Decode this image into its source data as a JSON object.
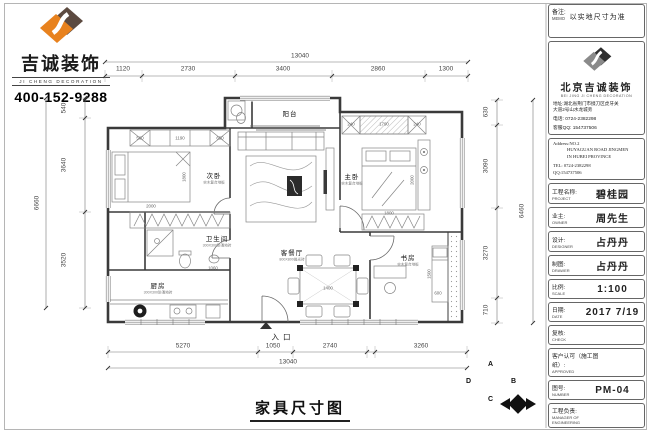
{
  "header": {
    "logo_cn": "吉诚装饰",
    "logo_en": "JI CHENG DECORATION",
    "phone": "400-152-9288"
  },
  "titleblock": {
    "memo_label": "备注:",
    "memo_label_en": "MEMO",
    "memo_text": "以实地尺寸为准",
    "company": {
      "name": "北京吉诚装饰",
      "name_en": "BEI JING JI CHENG DECORATION",
      "address1": "地址:湖北省荆门市掇刀区虎牙关",
      "address2": "大道2号山水龙城旁",
      "tel": "电话: 0724-2382298",
      "qq": "客服QQ: 154737506"
    },
    "address_en": {
      "line1": "Address:NO.2",
      "line2": "HUYAGUAN ROAD JINGMEN",
      "line3": "IN HUBEI PROVINCE",
      "tel": "TEL: 0724-2382298",
      "qq": "QQ:154737506"
    },
    "fields": [
      {
        "label": "工程名称:",
        "label_en": "PROJECT",
        "value": "碧桂园"
      },
      {
        "label": "业主:",
        "label_en": "OWNER",
        "value": "周先生"
      },
      {
        "label": "设计:",
        "label_en": "DESIGNER",
        "value": "占丹丹"
      },
      {
        "label": "制图:",
        "label_en": "DRAWER",
        "value": "占丹丹"
      },
      {
        "label": "比例:",
        "label_en": "SCALE",
        "value": "1:100"
      },
      {
        "label": "日期:",
        "label_en": "DATE",
        "value": "2017 7/19"
      },
      {
        "label": "复核:",
        "label_en": "CHECK",
        "value": ""
      },
      {
        "label": "客户认可（施工图纸）:",
        "label_en": "APPROVED",
        "value": ""
      },
      {
        "label": "图号:",
        "label_en": "NUMBER",
        "value": "PM-04"
      },
      {
        "label": "工程负责:",
        "label_en": "MANAGER OF ENGINEERING",
        "value": ""
      }
    ]
  },
  "plan": {
    "drawing_title": "家具尺寸图",
    "dims": {
      "top_overall": "13040",
      "top_segments": [
        "1120",
        "2730",
        "3400",
        "2860",
        "1300"
      ],
      "bottom_segments": [
        "5270",
        "1050",
        "2740",
        "3260"
      ],
      "bottom_overall": "13040",
      "left_outer": "6660",
      "left_segments": [
        "540",
        "3640",
        "3520"
      ],
      "right_segments": [
        "630",
        "3090",
        "3270",
        "710"
      ],
      "right_outer": "6460"
    },
    "labels": [
      {
        "text": "13040",
        "x": 300,
        "y": 56,
        "cls": "dim"
      },
      {
        "text": "1120",
        "x": 123,
        "y": 69,
        "cls": "dim"
      },
      {
        "text": "2730",
        "x": 188,
        "y": 69,
        "cls": "dim"
      },
      {
        "text": "3400",
        "x": 283,
        "y": 69,
        "cls": "dim"
      },
      {
        "text": "2860",
        "x": 378,
        "y": 69,
        "cls": "dim"
      },
      {
        "text": "1300",
        "x": 446,
        "y": 69,
        "cls": "dim"
      },
      {
        "text": "5270",
        "x": 183,
        "y": 346,
        "cls": "dim"
      },
      {
        "text": "1050",
        "x": 273,
        "y": 346,
        "cls": "dim"
      },
      {
        "text": "2740",
        "x": 330,
        "y": 346,
        "cls": "dim"
      },
      {
        "text": "3260",
        "x": 421,
        "y": 346,
        "cls": "dim"
      },
      {
        "text": "13040",
        "x": 288,
        "y": 362,
        "cls": "dim"
      },
      {
        "text": "540",
        "x": 64,
        "y": 108,
        "rot": -90,
        "cls": "dim"
      },
      {
        "text": "3640",
        "x": 64,
        "y": 165,
        "rot": -90,
        "cls": "dim"
      },
      {
        "text": "3520",
        "x": 64,
        "y": 260,
        "rot": -90,
        "cls": "dim"
      },
      {
        "text": "6660",
        "x": 37,
        "y": 203,
        "rot": -90,
        "cls": "dim"
      },
      {
        "text": "630",
        "x": 486,
        "y": 112,
        "rot": -90,
        "cls": "dim"
      },
      {
        "text": "3090",
        "x": 486,
        "y": 166,
        "rot": -90,
        "cls": "dim"
      },
      {
        "text": "3270",
        "x": 486,
        "y": 253,
        "rot": -90,
        "cls": "dim"
      },
      {
        "text": "710",
        "x": 486,
        "y": 310,
        "rot": -90,
        "cls": "dim"
      },
      {
        "text": "6460",
        "x": 522,
        "y": 211,
        "rot": -90,
        "cls": "dim"
      },
      {
        "text": "阳台",
        "x": 290,
        "y": 113,
        "cls": "room"
      },
      {
        "text": "次卧",
        "x": 214,
        "y": 175,
        "cls": "room"
      },
      {
        "text": "实木复合地板",
        "x": 214,
        "y": 183,
        "cls": "roomsub"
      },
      {
        "text": "主卧",
        "x": 352,
        "y": 176,
        "cls": "room"
      },
      {
        "text": "实木复合地板",
        "x": 352,
        "y": 184,
        "cls": "roomsub"
      },
      {
        "text": "卫生间",
        "x": 217,
        "y": 238,
        "cls": "room"
      },
      {
        "text": "300X300防滑地砖",
        "x": 217,
        "y": 246,
        "cls": "roomsub"
      },
      {
        "text": "厨房",
        "x": 158,
        "y": 285,
        "cls": "room"
      },
      {
        "text": "300X300防滑地砖",
        "x": 158,
        "y": 293,
        "cls": "roomsub"
      },
      {
        "text": "客餐厅",
        "x": 292,
        "y": 252,
        "cls": "room"
      },
      {
        "text": "800X800抛光砖",
        "x": 292,
        "y": 260,
        "cls": "roomsub"
      },
      {
        "text": "书房",
        "x": 408,
        "y": 257,
        "cls": "room"
      },
      {
        "text": "实木复合地板",
        "x": 408,
        "y": 265,
        "cls": "roomsub"
      },
      {
        "text": "入口",
        "x": 283,
        "y": 337,
        "cls": "entrance"
      },
      {
        "text": "560",
        "x": 140,
        "y": 138,
        "cls": "fdim"
      },
      {
        "text": "1190",
        "x": 180,
        "y": 138,
        "cls": "fdim"
      },
      {
        "text": "650",
        "x": 220,
        "y": 138,
        "cls": "fdim"
      },
      {
        "text": "1800",
        "x": 184,
        "y": 177,
        "rot": -90,
        "cls": "fdim"
      },
      {
        "text": "2000",
        "x": 151,
        "y": 206,
        "cls": "fdim"
      },
      {
        "text": "240",
        "x": 351,
        "y": 124,
        "cls": "fdim"
      },
      {
        "text": "1790",
        "x": 384,
        "y": 124,
        "cls": "fdim"
      },
      {
        "text": "240",
        "x": 417,
        "y": 124,
        "cls": "fdim"
      },
      {
        "text": "2000",
        "x": 412,
        "y": 180,
        "rot": -90,
        "cls": "fdim"
      },
      {
        "text": "1800",
        "x": 389,
        "y": 213,
        "cls": "fdim"
      },
      {
        "text": "1400",
        "x": 328,
        "y": 288,
        "cls": "fdim"
      },
      {
        "text": "1500",
        "x": 429,
        "y": 274,
        "rot": -90,
        "cls": "fdim"
      },
      {
        "text": "1060",
        "x": 213,
        "y": 268,
        "cls": "fdim"
      },
      {
        "text": "600",
        "x": 438,
        "y": 293,
        "cls": "fdim"
      },
      {
        "text": "A",
        "x": 518,
        "y": 387,
        "cls": "compass"
      },
      {
        "text": "B",
        "x": 541,
        "y": 404,
        "cls": "compass"
      },
      {
        "text": "C",
        "x": 518,
        "y": 422,
        "cls": "compass"
      },
      {
        "text": "D",
        "x": 496,
        "y": 404,
        "cls": "compass"
      }
    ]
  }
}
